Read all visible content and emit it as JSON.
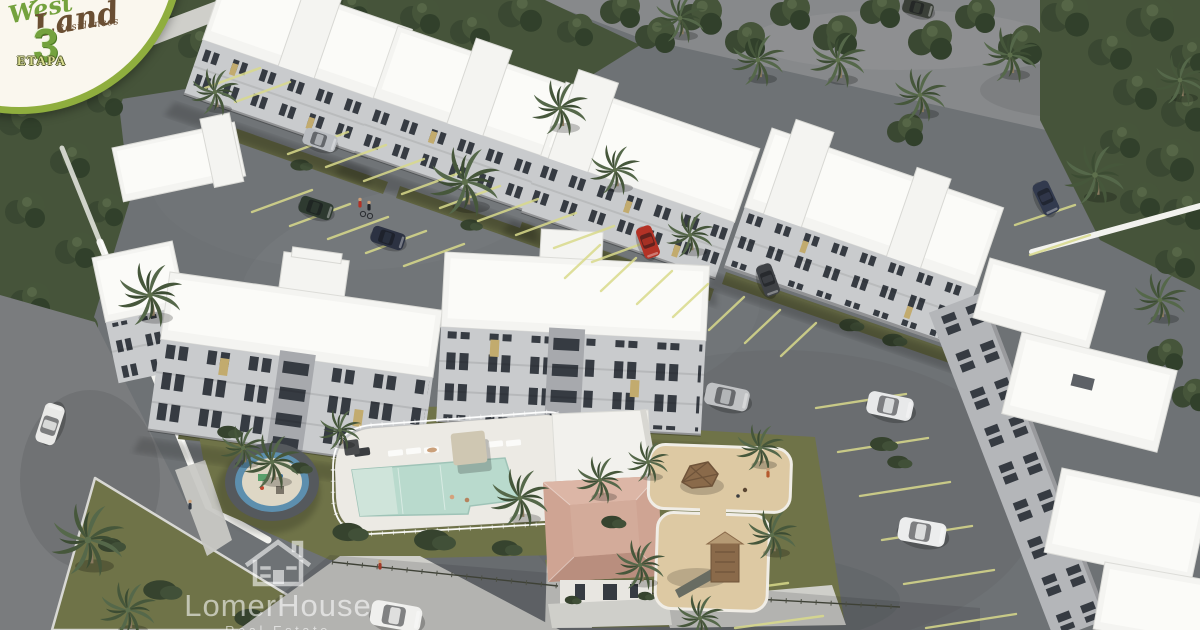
{
  "image": {
    "type": "3d-aerial-architectural-render",
    "subject": "West Land Residences - stage 3 apartment complex",
    "setting": "tropical residential development surrounded by dense trees and palm trees"
  },
  "badge": {
    "line1": "West",
    "line2": "Land",
    "line3": "Residences",
    "stage_number": "3",
    "stage_word": "ETAPA"
  },
  "watermark": {
    "brand": "LomerHouse",
    "tagline": "Real Estate",
    "icon": "house-outline-icon"
  },
  "scene_elements": {
    "buildings": "white flat-roof 4-storey apartment blocks in three rows",
    "amenities": [
      "swimming pool with deck and loungers",
      "circular splash pad",
      "clubhouse with tan hip roof",
      "sand playground with wooden climbers"
    ],
    "vehicles": "cars parked in striped parking bays",
    "landscape": [
      "palm trees",
      "broadleaf trees",
      "lawns",
      "hedges",
      "white perimeter wall"
    ]
  },
  "palette": {
    "vegetation": "#46543a",
    "asphalt": "#6e7275",
    "asphalt_dark": "#5f6367",
    "road_top": "#87898b",
    "roof_white": "#f4f4f1",
    "facade_light": "#c9cbcd",
    "facade_shade": "#a7a9ad",
    "window_dark": "#363b42",
    "window_lit": "#c2ab6e",
    "lawn": "#6f7348",
    "sand": "#ddc9a3",
    "pool_water": "#b9dacd",
    "pool_deck": "#eceae4",
    "club_roof": "#cfa493",
    "path_light": "#cfcfca",
    "wall_white": "#f2f2ee",
    "stripe_yellow": "#d8d98b",
    "badge_bg": "#faf7ee",
    "badge_green": "#74a23e",
    "badge_brown": "#6a4f33",
    "badge_stage_fill": "#d8dc8f",
    "badge_ring": "#8fae3e",
    "watermark_white": "rgba(255,255,255,0.58)"
  }
}
